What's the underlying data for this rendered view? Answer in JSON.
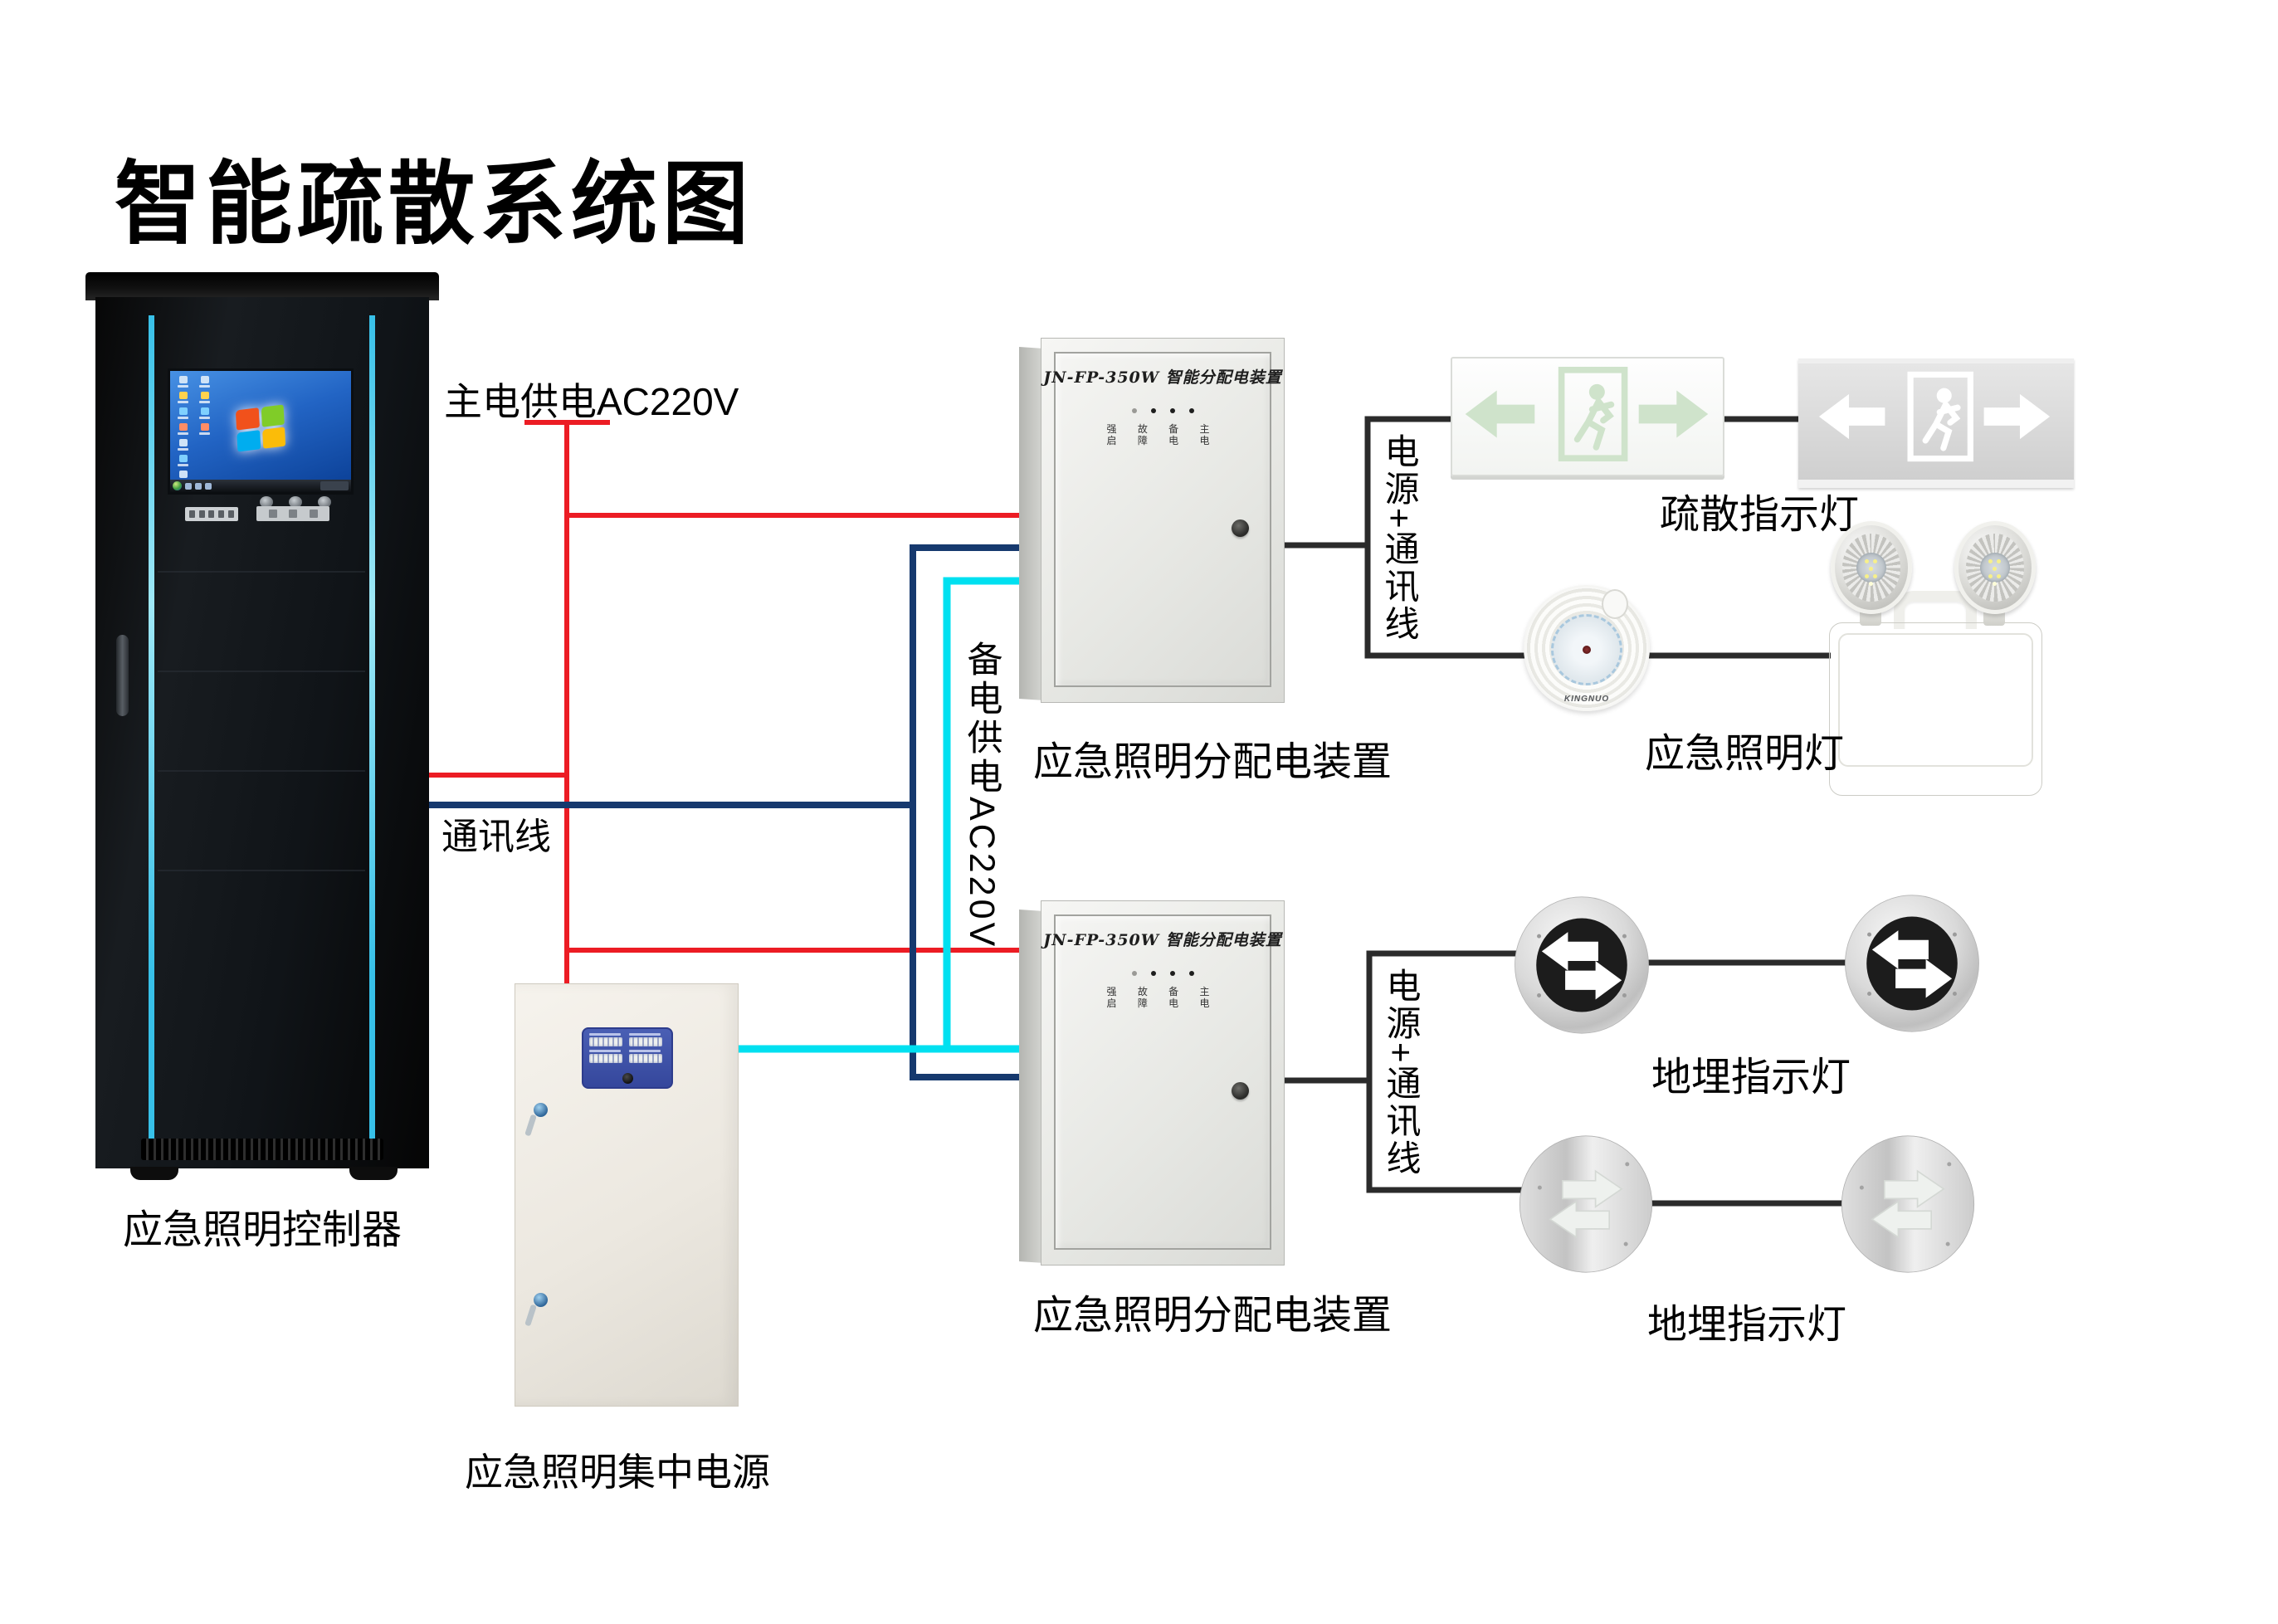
{
  "title": "智能疏散系统图",
  "colors": {
    "main_power_wire": "#ec1c24",
    "comm_wire": "#16396e",
    "backup_power_wire": "#00e0f0",
    "device_wire": "#2b2b2b",
    "rack_accent": "#37c0e8",
    "panel_blue": "#4a5fb4"
  },
  "wires": {
    "main_power_label": "主电供电AC220V",
    "comm_label": "通讯线",
    "backup_power_label": "备电供电AC220V",
    "power_comm_label_1": "电源+通讯线",
    "power_comm_label_2": "电源+通讯线"
  },
  "devices": {
    "controller": {
      "label": "应急照明控制器"
    },
    "central_power": {
      "label": "应急照明集中电源"
    },
    "dist_box_1": {
      "label": "应急照明分配电装置",
      "panel_title": "JN-FP-350W 智能分配电装置",
      "indicator_row_1": "强 故 备 主",
      "indicator_row_2": "启 障 电 电"
    },
    "dist_box_2": {
      "label": "应急照明分配电装置",
      "panel_title": "JN-FP-350W 智能分配电装置",
      "indicator_row_1": "强 故 备 主",
      "indicator_row_2": "启 障 电 电"
    },
    "exit_sign_group": {
      "label": "疏散指示灯"
    },
    "emergency_light_group": {
      "label": "应急照明灯",
      "dome_brand": "KINGNUO"
    },
    "ground_light_group_1": {
      "label": "地埋指示灯"
    },
    "ground_light_group_2": {
      "label": "地埋指示灯"
    }
  }
}
